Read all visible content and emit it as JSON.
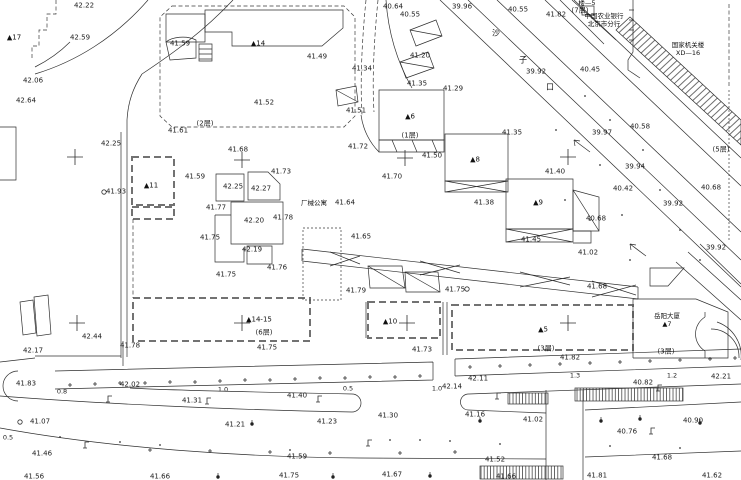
{
  "canvas": {
    "width": 741,
    "height": 480,
    "bg": "#ffffff",
    "line_color": "#2f2f2f"
  },
  "street": {
    "name_chars": [
      {
        "t": "沙",
        "x": 496,
        "y": 33
      },
      {
        "t": "子",
        "x": 523,
        "y": 60
      },
      {
        "t": "口",
        "x": 550,
        "y": 87
      }
    ]
  },
  "annotations": [
    {
      "id": "bank",
      "x": 604,
      "y": 13,
      "lines": [
        "中国农业银行",
        "北京市分行"
      ]
    },
    {
      "id": "gov",
      "x": 688,
      "y": 42,
      "lines": [
        "国家机关楼",
        "XD—16"
      ]
    },
    {
      "id": "annex5",
      "x": 587,
      "y": 0,
      "lines": [
        "楼—5"
      ]
    },
    {
      "id": "apartment",
      "x": 314,
      "y": 200,
      "lines": [
        "厂械公寓"
      ]
    },
    {
      "id": "tower",
      "x": 667,
      "y": 313,
      "lines": [
        "岳阳大厦",
        "▲7"
      ]
    }
  ],
  "buildings": [
    {
      "t": "▲17",
      "x": 14,
      "y": 38
    },
    {
      "t": "▲14",
      "x": 258,
      "y": 44
    },
    {
      "t": "▲11",
      "x": 151,
      "y": 186
    },
    {
      "t": "▲6",
      "x": 410,
      "y": 117
    },
    {
      "t": "▲8",
      "x": 475,
      "y": 160
    },
    {
      "t": "▲9",
      "x": 538,
      "y": 203
    },
    {
      "t": "▲10",
      "x": 390,
      "y": 322
    },
    {
      "t": "▲5",
      "x": 543,
      "y": 330
    },
    {
      "t": "▲14-15",
      "x": 259,
      "y": 320
    }
  ],
  "floor_notes": [
    {
      "t": "(2层)",
      "x": 205,
      "y": 124
    },
    {
      "t": "(1层)",
      "x": 410,
      "y": 136
    },
    {
      "t": "(6层)",
      "x": 264,
      "y": 333
    },
    {
      "t": "(3层)",
      "x": 546,
      "y": 349
    },
    {
      "t": "(3层)",
      "x": 666,
      "y": 352
    },
    {
      "t": "(5层)",
      "x": 721,
      "y": 150
    },
    {
      "t": "(7层)",
      "x": 580,
      "y": 11
    }
  ],
  "dimensions": [
    {
      "t": "0.8",
      "x": 62,
      "y": 392
    },
    {
      "t": "1.0",
      "x": 223,
      "y": 390
    },
    {
      "t": "0.5",
      "x": 348,
      "y": 389
    },
    {
      "t": "1.0",
      "x": 437,
      "y": 389
    },
    {
      "t": "1.3",
      "x": 575,
      "y": 376
    },
    {
      "t": "1.2",
      "x": 672,
      "y": 376
    },
    {
      "t": "0.5",
      "x": 8,
      "y": 438
    }
  ],
  "elevations": [
    {
      "t": "42.22",
      "x": 84,
      "y": 6
    },
    {
      "t": "42.59",
      "x": 80,
      "y": 38
    },
    {
      "t": "42.06",
      "x": 33,
      "y": 81
    },
    {
      "t": "42.64",
      "x": 26,
      "y": 101
    },
    {
      "t": "42.25",
      "x": 111,
      "y": 144
    },
    {
      "t": "41.59",
      "x": 180,
      "y": 44
    },
    {
      "t": "41.61",
      "x": 178,
      "y": 131
    },
    {
      "t": "41.68",
      "x": 238,
      "y": 150
    },
    {
      "t": "41.49",
      "x": 317,
      "y": 57
    },
    {
      "t": "41.52",
      "x": 264,
      "y": 103
    },
    {
      "t": "41.51",
      "x": 356,
      "y": 111
    },
    {
      "t": "41.34",
      "x": 362,
      "y": 69
    },
    {
      "t": "41.20",
      "x": 420,
      "y": 56
    },
    {
      "t": "40.64",
      "x": 393,
      "y": 7
    },
    {
      "t": "40.55",
      "x": 410,
      "y": 15
    },
    {
      "t": "39.96",
      "x": 462,
      "y": 7
    },
    {
      "t": "40.55",
      "x": 518,
      "y": 10
    },
    {
      "t": "41.82",
      "x": 556,
      "y": 15
    },
    {
      "t": "39.92",
      "x": 536,
      "y": 72
    },
    {
      "t": "40.45",
      "x": 590,
      "y": 70
    },
    {
      "t": "41.35",
      "x": 417,
      "y": 84
    },
    {
      "t": "41.29",
      "x": 453,
      "y": 89
    },
    {
      "t": "41.35",
      "x": 512,
      "y": 133
    },
    {
      "t": "39.97",
      "x": 602,
      "y": 133
    },
    {
      "t": "40.58",
      "x": 640,
      "y": 127
    },
    {
      "t": "39.94",
      "x": 635,
      "y": 167
    },
    {
      "t": "40.42",
      "x": 623,
      "y": 189
    },
    {
      "t": "39.92",
      "x": 673,
      "y": 204
    },
    {
      "t": "40.68",
      "x": 711,
      "y": 188
    },
    {
      "t": "40.68",
      "x": 596,
      "y": 219
    },
    {
      "t": "39.92",
      "x": 716,
      "y": 248
    },
    {
      "t": "41.02",
      "x": 588,
      "y": 253
    },
    {
      "t": "41.72",
      "x": 358,
      "y": 147
    },
    {
      "t": "41.50",
      "x": 432,
      "y": 156
    },
    {
      "t": "41.70",
      "x": 392,
      "y": 177
    },
    {
      "t": "41.40",
      "x": 555,
      "y": 172
    },
    {
      "t": "41.38",
      "x": 484,
      "y": 203
    },
    {
      "t": "41.45",
      "x": 531,
      "y": 240
    },
    {
      "t": "41.93",
      "x": 116,
      "y": 192
    },
    {
      "t": "41.59",
      "x": 195,
      "y": 177
    },
    {
      "t": "41.73",
      "x": 281,
      "y": 172
    },
    {
      "t": "42.25",
      "x": 233,
      "y": 187
    },
    {
      "t": "42.27",
      "x": 261,
      "y": 189
    },
    {
      "t": "41.77",
      "x": 216,
      "y": 208
    },
    {
      "t": "42.20",
      "x": 254,
      "y": 221
    },
    {
      "t": "41.78",
      "x": 283,
      "y": 218
    },
    {
      "t": "41.75",
      "x": 210,
      "y": 238
    },
    {
      "t": "42.19",
      "x": 252,
      "y": 250
    },
    {
      "t": "41.76",
      "x": 277,
      "y": 268
    },
    {
      "t": "41.75",
      "x": 226,
      "y": 275
    },
    {
      "t": "41.64",
      "x": 345,
      "y": 203
    },
    {
      "t": "41.65",
      "x": 361,
      "y": 237
    },
    {
      "t": "41.79",
      "x": 356,
      "y": 291
    },
    {
      "t": "41.75",
      "x": 455,
      "y": 290
    },
    {
      "t": "41.68",
      "x": 597,
      "y": 287
    },
    {
      "t": "42.44",
      "x": 92,
      "y": 337
    },
    {
      "t": "42.17",
      "x": 33,
      "y": 351
    },
    {
      "t": "41.78",
      "x": 130,
      "y": 346
    },
    {
      "t": "41.83",
      "x": 26,
      "y": 384
    },
    {
      "t": "42.02",
      "x": 130,
      "y": 385
    },
    {
      "t": "41.75",
      "x": 267,
      "y": 348
    },
    {
      "t": "41.73",
      "x": 422,
      "y": 350
    },
    {
      "t": "41.82",
      "x": 570,
      "y": 358
    },
    {
      "t": "42.11",
      "x": 478,
      "y": 379
    },
    {
      "t": "42.14",
      "x": 452,
      "y": 387
    },
    {
      "t": "42.21",
      "x": 721,
      "y": 377
    },
    {
      "t": "40.82",
      "x": 643,
      "y": 383
    },
    {
      "t": "41.31",
      "x": 192,
      "y": 401
    },
    {
      "t": "41.40",
      "x": 297,
      "y": 396
    },
    {
      "t": "41.07",
      "x": 40,
      "y": 422
    },
    {
      "t": "41.21",
      "x": 235,
      "y": 425
    },
    {
      "t": "41.23",
      "x": 327,
      "y": 422
    },
    {
      "t": "41.30",
      "x": 388,
      "y": 416
    },
    {
      "t": "41.16",
      "x": 475,
      "y": 415
    },
    {
      "t": "41.02",
      "x": 533,
      "y": 420
    },
    {
      "t": "40.90",
      "x": 693,
      "y": 421
    },
    {
      "t": "40.76",
      "x": 627,
      "y": 432
    },
    {
      "t": "41.46",
      "x": 42,
      "y": 454
    },
    {
      "t": "41.59",
      "x": 297,
      "y": 457
    },
    {
      "t": "41.52",
      "x": 495,
      "y": 460
    },
    {
      "t": "41.68",
      "x": 662,
      "y": 458
    },
    {
      "t": "41.56",
      "x": 34,
      "y": 477
    },
    {
      "t": "41.66",
      "x": 160,
      "y": 477
    },
    {
      "t": "41.75",
      "x": 289,
      "y": 476
    },
    {
      "t": "41.67",
      "x": 392,
      "y": 475
    },
    {
      "t": "41.66",
      "x": 506,
      "y": 477
    },
    {
      "t": "41.81",
      "x": 597,
      "y": 476
    },
    {
      "t": "41.62",
      "x": 712,
      "y": 476
    }
  ],
  "symbols": {
    "crosses": [
      [
        75,
        157
      ],
      [
        242,
        160
      ],
      [
        405,
        158
      ],
      [
        568,
        157
      ],
      [
        77,
        323
      ],
      [
        242,
        323
      ],
      [
        407,
        323
      ],
      [
        568,
        323
      ]
    ],
    "plus_ticks": [
      [
        70,
        385
      ],
      [
        95,
        384
      ],
      [
        120,
        383
      ],
      [
        145,
        383
      ],
      [
        170,
        382
      ],
      [
        195,
        382
      ],
      [
        220,
        381
      ],
      [
        245,
        380
      ],
      [
        270,
        380
      ],
      [
        295,
        379
      ],
      [
        320,
        378
      ],
      [
        345,
        378
      ],
      [
        370,
        377
      ],
      [
        395,
        377
      ],
      [
        420,
        376
      ],
      [
        470,
        367
      ],
      [
        500,
        366
      ],
      [
        530,
        365
      ],
      [
        560,
        364
      ],
      [
        590,
        363
      ],
      [
        620,
        362
      ],
      [
        650,
        361
      ],
      [
        680,
        360
      ],
      [
        710,
        359
      ],
      [
        735,
        358
      ],
      [
        150,
        450
      ],
      [
        210,
        451
      ],
      [
        270,
        452
      ],
      [
        330,
        453
      ],
      [
        400,
        453
      ],
      [
        455,
        452
      ]
    ],
    "lamps": [
      [
        108,
        402
      ],
      [
        207,
        404
      ],
      [
        318,
        402
      ],
      [
        85,
        448
      ],
      [
        368,
        446
      ],
      [
        497,
        399
      ],
      [
        658,
        391
      ],
      [
        651,
        434
      ]
    ],
    "trees": [
      [
        252,
        424
      ],
      [
        480,
        421
      ],
      [
        640,
        419
      ],
      [
        700,
        423
      ],
      [
        218,
        477
      ],
      [
        333,
        477
      ],
      [
        430,
        476
      ],
      [
        601,
        421
      ]
    ],
    "circles": [
      [
        104,
        192
      ],
      [
        20,
        422
      ],
      [
        467,
        289
      ]
    ],
    "dots": [
      [
        585,
        96
      ],
      [
        610,
        120
      ],
      [
        643,
        150
      ],
      [
        556,
        130
      ],
      [
        600,
        165
      ],
      [
        660,
        190
      ],
      [
        622,
        215
      ],
      [
        680,
        230
      ],
      [
        700,
        260
      ],
      [
        590,
        220
      ],
      [
        630,
        260
      ],
      [
        565,
        200
      ],
      [
        420,
        440
      ],
      [
        450,
        441
      ],
      [
        390,
        440
      ],
      [
        500,
        444
      ],
      [
        610,
        446
      ],
      [
        680,
        448
      ],
      [
        160,
        445
      ],
      [
        120,
        442
      ],
      [
        60,
        437
      ],
      [
        290,
        450
      ]
    ]
  }
}
